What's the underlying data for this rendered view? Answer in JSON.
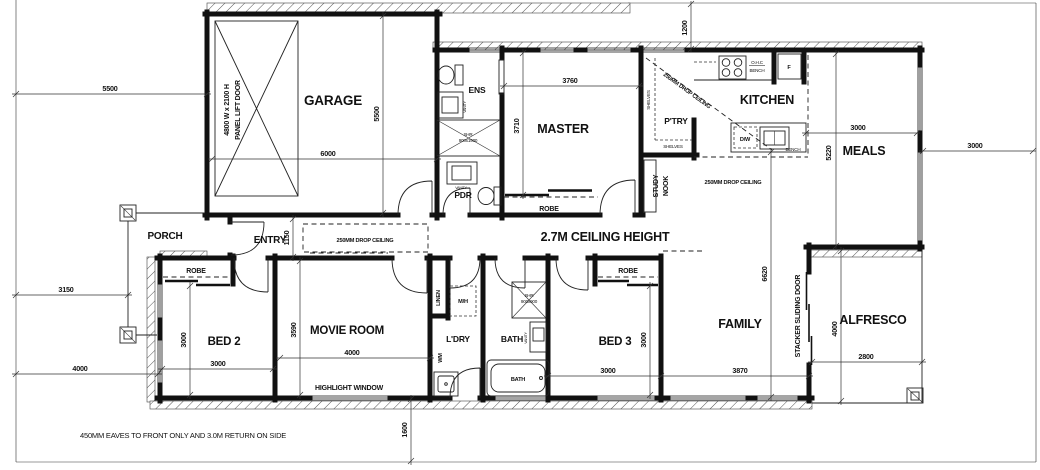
{
  "colors": {
    "line": "#111111",
    "background": "#ffffff"
  },
  "rooms": {
    "garage": "GARAGE",
    "porch": "PORCH",
    "entry": "ENTRY",
    "ens": "ENS",
    "pdr": "PDR",
    "master": "MASTER",
    "pantry": "P'TRY",
    "study_nook_l1": "STUDY",
    "study_nook_l2": "NOOK",
    "kitchen": "KITCHEN",
    "meals": "MEALS",
    "bed2": "BED 2",
    "movie_room": "MOVIE ROOM",
    "laundry": "L'DRY",
    "bath": "BATH",
    "bed3": "BED 3",
    "family": "FAMILY",
    "alfresco": "ALFRESCO"
  },
  "fixtures": {
    "robe": "ROBE",
    "linen": "LINEN",
    "wm": "WM",
    "mh": "M/H",
    "dw": "D/W",
    "fridge": "F",
    "bench": "BENCH",
    "ohc": "O.H.C",
    "shelves": "SHELVES",
    "vanity": "VANITY",
    "bath_tub": "BATH",
    "shower_ens_l1": "SHR",
    "shower_ens_l2": "900x1900",
    "shower_bath_l1": "SHR",
    "shower_bath_l2": "900x900",
    "panel_door_l1": "4800 W x 2100 H",
    "panel_door_l2": "PANEL LIFT DOOR",
    "highlight_window": "HIGHLIGHT WINDOW",
    "stacker_door": "STACKER SLIDING DOOR"
  },
  "dimensions": {
    "site_front": "5500",
    "garage_w": "6000",
    "garage_d": "5500",
    "master_w": "3760",
    "master_d": "3710",
    "front_setback": "1200",
    "meals_w": "3000",
    "side_setback": "3000",
    "meals_d": "5220",
    "entry_d": "1150",
    "porch_setback": "3150",
    "side_left": "4000",
    "bed2_d": "3000",
    "bed2_w": "3000",
    "movie_d": "3590",
    "movie_w": "4000",
    "bed3_d": "3000",
    "bed3_w": "3000",
    "family_w": "3870",
    "family_d": "6620",
    "alfresco_d": "4000",
    "alfresco_w": "2800",
    "rear_setback": "1600"
  },
  "notes": {
    "ceiling": "2.7M CEILING HEIGHT",
    "drop_ceiling": "250MM DROP CEILING",
    "eaves": "450MM EAVES TO FRONT ONLY AND 3.0M RETURN ON SIDE"
  }
}
